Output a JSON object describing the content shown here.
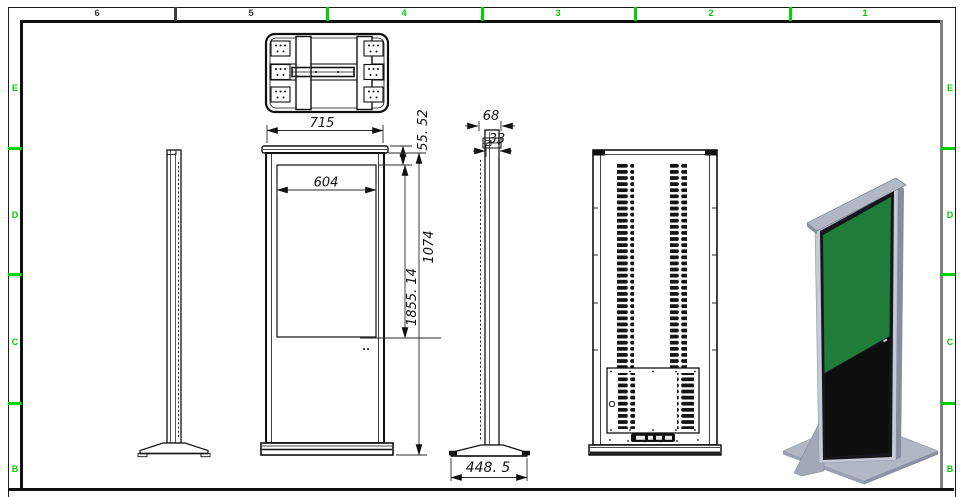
{
  "frame": {
    "column_labels": [
      {
        "label": "6",
        "color": "#3f4242"
      },
      {
        "label": "5",
        "color": "#3f4242"
      },
      {
        "label": "4",
        "color": "#00cd00"
      },
      {
        "label": "3",
        "color": "#00cd00"
      },
      {
        "label": "2",
        "color": "#00cd00"
      },
      {
        "label": "1",
        "color": "#00cd00"
      }
    ],
    "row_labels": [
      {
        "label": "E"
      },
      {
        "label": "D"
      },
      {
        "label": "C"
      },
      {
        "label": "B"
      }
    ],
    "accent_green": "#00cd00"
  },
  "dimensions": {
    "cabinet_width": "715",
    "display_width": "604",
    "top_inset": "55. 52",
    "display_height": "1074",
    "overall_height": "1855. 14",
    "depth": "68",
    "body_thickness": "33",
    "base_depth": "448. 5"
  },
  "colors": {
    "screen_green": "#1f7c39",
    "panel_black": "#0e0e0e",
    "metal_light": "#b2b7c6",
    "metal_mid": "#9aa0b2",
    "metal_dark": "#6e7487"
  }
}
